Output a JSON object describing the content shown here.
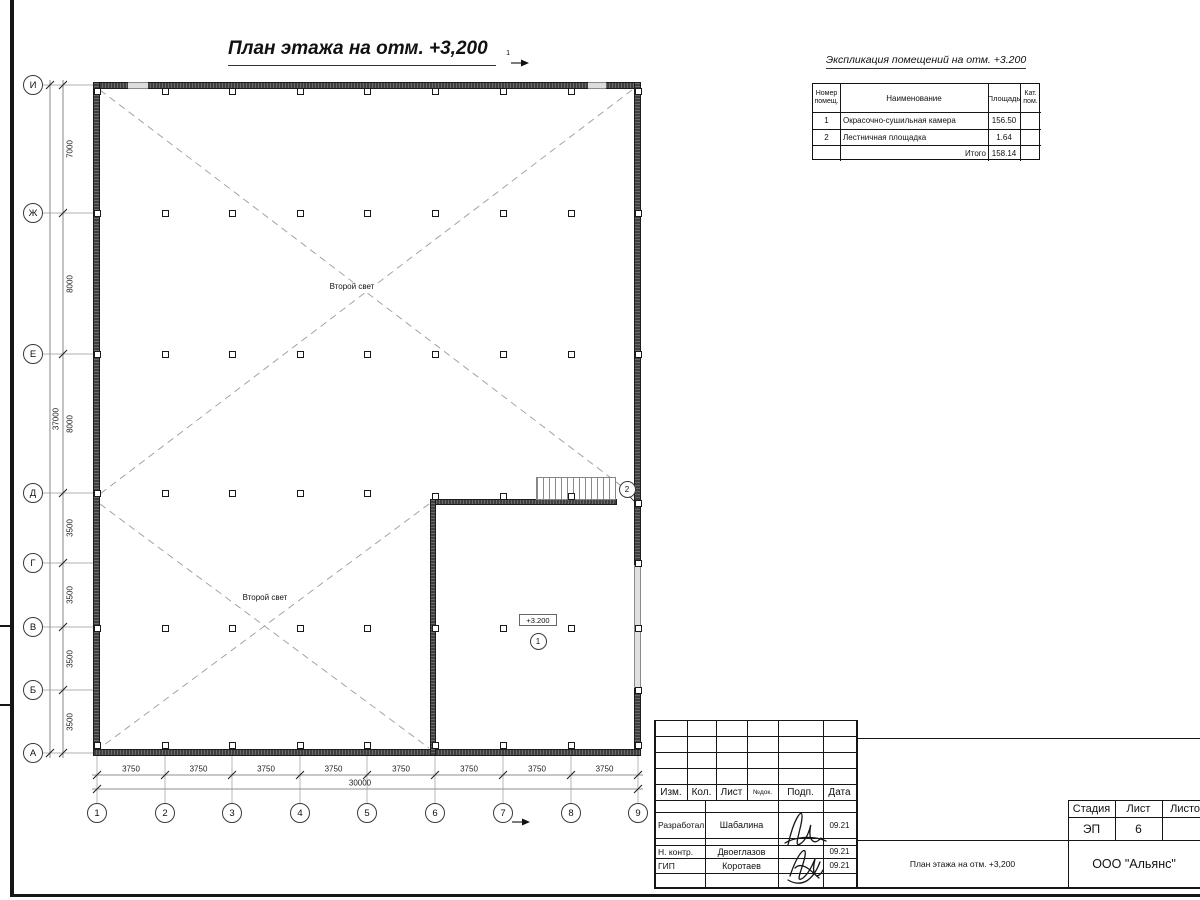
{
  "sheet": {
    "plan_title": "План этажа на отм. +3,200",
    "section_label": "1"
  },
  "plan": {
    "second_light": "Второй свет",
    "level_mark": "+3.200",
    "room1_bubble": "1",
    "room2_bubble": "2"
  },
  "grid": {
    "bottom_axes": [
      "1",
      "2",
      "3",
      "4",
      "5",
      "6",
      "7",
      "8",
      "9"
    ],
    "left_axes": [
      "И",
      "Ж",
      "Е",
      "Д",
      "Г",
      "В",
      "Б",
      "А"
    ],
    "bottom_dims": [
      "3750",
      "3750",
      "3750",
      "3750",
      "3750",
      "3750",
      "3750",
      "3750"
    ],
    "bottom_total": "30000",
    "left_dims": [
      "7000",
      "8000",
      "8000",
      "3500",
      "3500",
      "3500",
      "3500"
    ],
    "left_total": "37000"
  },
  "expl_table": {
    "title": "Экспликация помещений на отм. +3.200",
    "col_num": "Номер помещ.",
    "col_name": "Наименование",
    "col_area": "Площадь",
    "col_cat": "Кат. пом.",
    "rows": [
      {
        "num": "1",
        "name": "Окрасочно-сушильная камера",
        "area": "156.50",
        "cat": ""
      },
      {
        "num": "2",
        "name": "Лестничная площадка",
        "area": "1.64",
        "cat": ""
      }
    ],
    "total_label": "Итого",
    "total_area": "158.14"
  },
  "title_block": {
    "rev_cols": [
      "Изм.",
      "Кол.",
      "Лист",
      "№док.",
      "Подп.",
      "Дата"
    ],
    "staff": [
      {
        "role": "Разработал",
        "name": "Шабалина",
        "date": "09.21"
      },
      {
        "role": "Н. контр.",
        "name": "Двоеглазов",
        "date": "09.21"
      },
      {
        "role": "ГИП",
        "name": "Коротаев",
        "date": "09.21"
      }
    ],
    "stage_label": "Стадия",
    "stage": "ЭП",
    "sheet_label": "Лист",
    "sheet": "6",
    "sheets_label": "Листов",
    "doc_title": "План этажа на отм. +3,200",
    "company": "ООО \"Альянс\""
  }
}
